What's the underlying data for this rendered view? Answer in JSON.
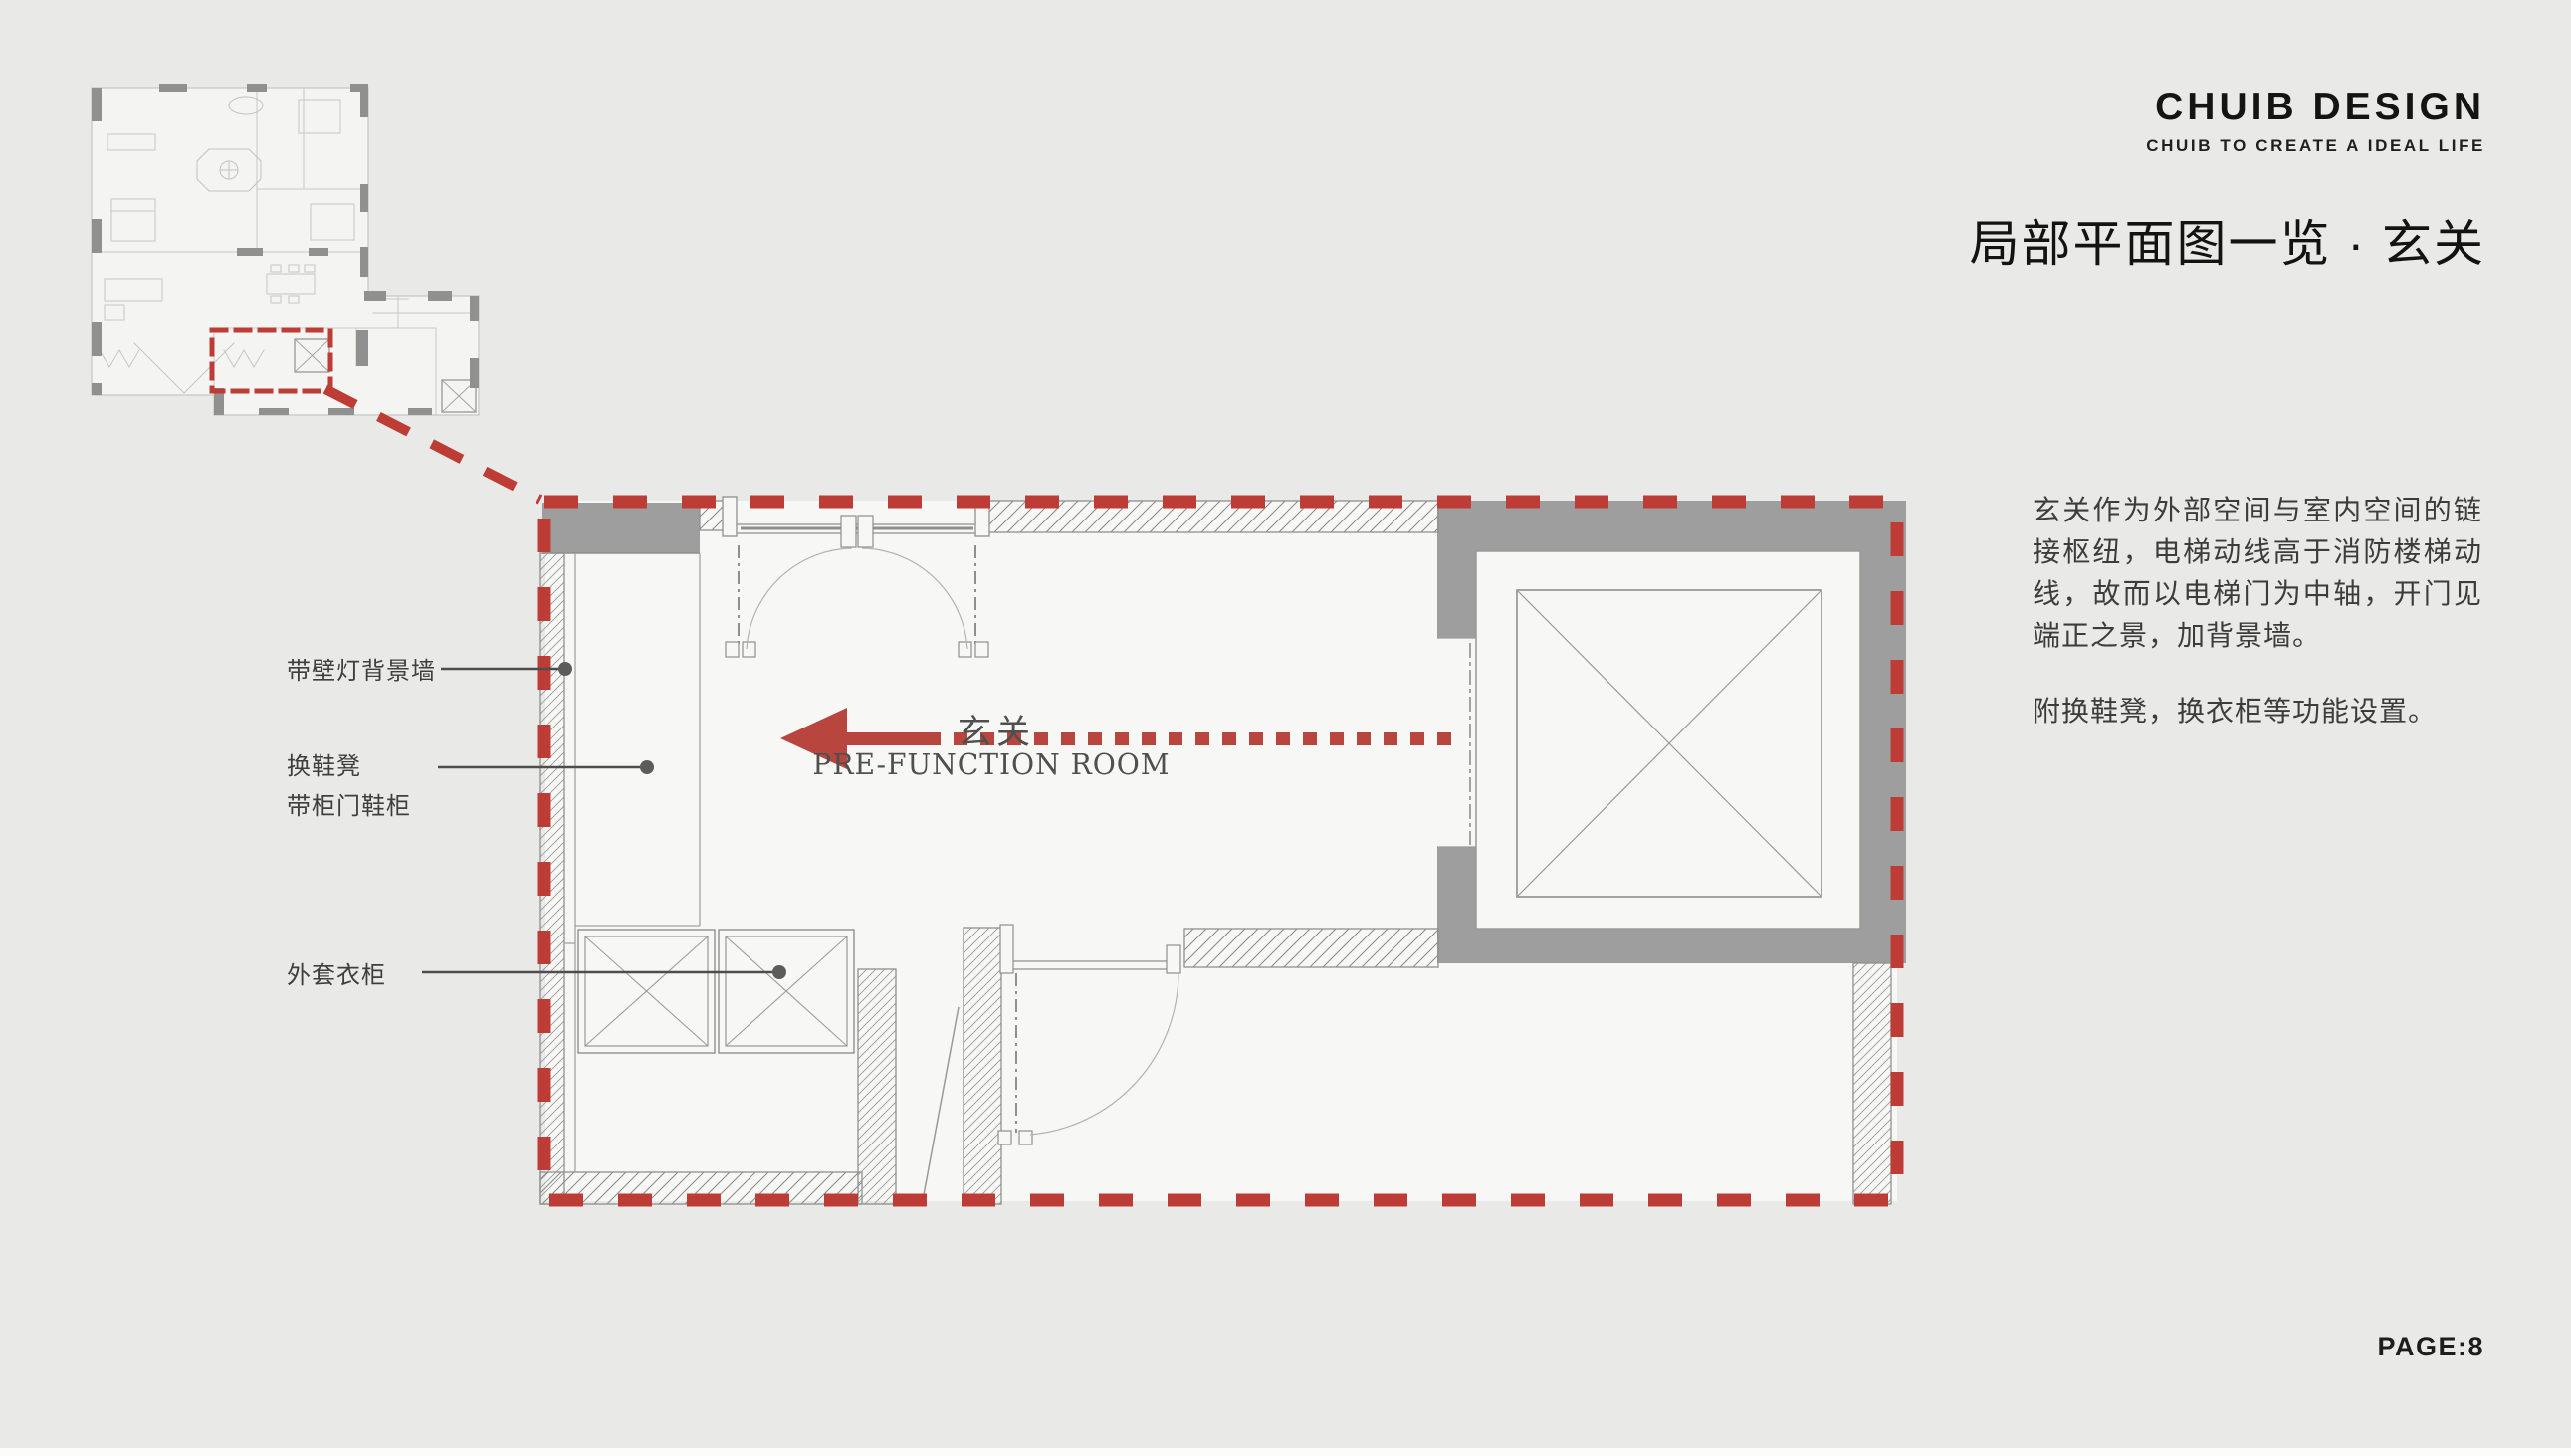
{
  "header": {
    "logo": "CHUIB DESIGN",
    "tagline": "CHUIB TO CREATE A IDEAL LIFE",
    "page_title": "局部平面图一览 · 玄关"
  },
  "plan": {
    "room_label_cn": "玄关",
    "room_label_en": "PRE-FUNCTION ROOM",
    "annotations": [
      {
        "label": "带壁灯背景墙"
      },
      {
        "label": "换鞋凳\n带柜门鞋柜"
      },
      {
        "label": "外套衣柜"
      }
    ]
  },
  "description": {
    "paragraph1": "玄关作为外部空间与室内空间的链接枢纽，电梯动线高于消防楼梯动线，故而以电梯门为中轴，开门见端正之景，加背景墙。",
    "paragraph2": "附换鞋凳，换衣柜等功能设置。"
  },
  "footer": {
    "page_label": "PAGE:8"
  },
  "colors": {
    "accent_red": "#bd3d36",
    "wall_gray": "#9e9e9e",
    "floor_white": "#f7f7f5",
    "page_background": "#e9e9e7"
  }
}
